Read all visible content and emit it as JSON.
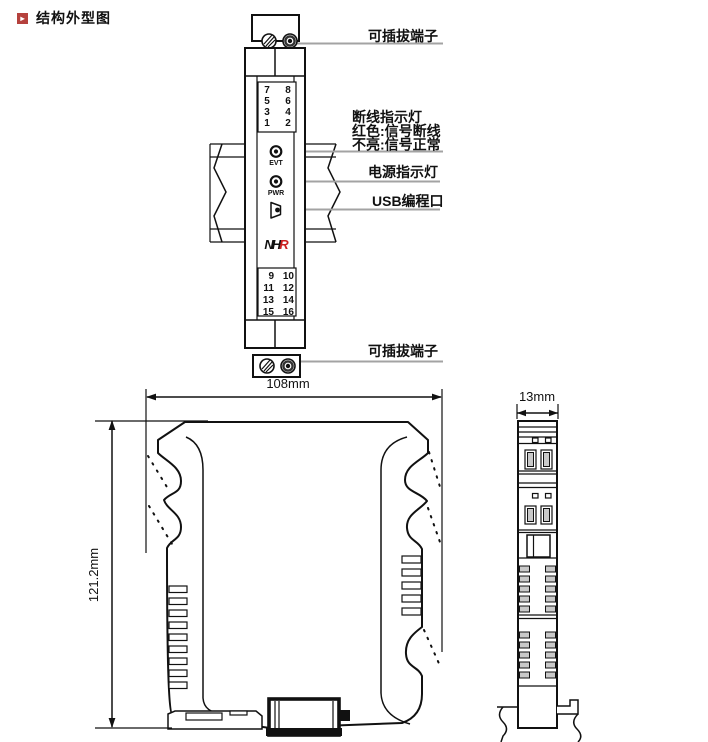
{
  "title": {
    "icon_glyph": "▸",
    "text": "结构外型图"
  },
  "front_view": {
    "top_terminals": [
      [
        "7",
        "8"
      ],
      [
        "5",
        "6"
      ],
      [
        "3",
        "4"
      ],
      [
        "1",
        "2"
      ]
    ],
    "bottom_terminals": [
      [
        "9",
        "10"
      ],
      [
        "11",
        "12"
      ],
      [
        "13",
        "14"
      ],
      [
        "15",
        "16"
      ]
    ],
    "evt_label": "EVT",
    "pwr_label": "PWR",
    "logo": {
      "n": "N",
      "h": "H",
      "r": "R"
    }
  },
  "annotations": {
    "top_terminal": "可插拔端子",
    "break_indicator_title": "断线指示灯",
    "break_indicator_line2": "红色:信号断线",
    "break_indicator_line3": "不亮:信号正常",
    "power_indicator": "电源指示灯",
    "usb_port": "USB编程口",
    "bottom_terminal": "可插拔端子"
  },
  "dimensions": {
    "width": "108mm",
    "height": "121.2mm",
    "depth": "13mm"
  },
  "colors": {
    "line": "#111111",
    "leader_line": "#a3a3a3",
    "logo_red": "#cc1f1f",
    "title_icon_bg": "#b5413d",
    "slot_fill": "#c9c9c9"
  }
}
